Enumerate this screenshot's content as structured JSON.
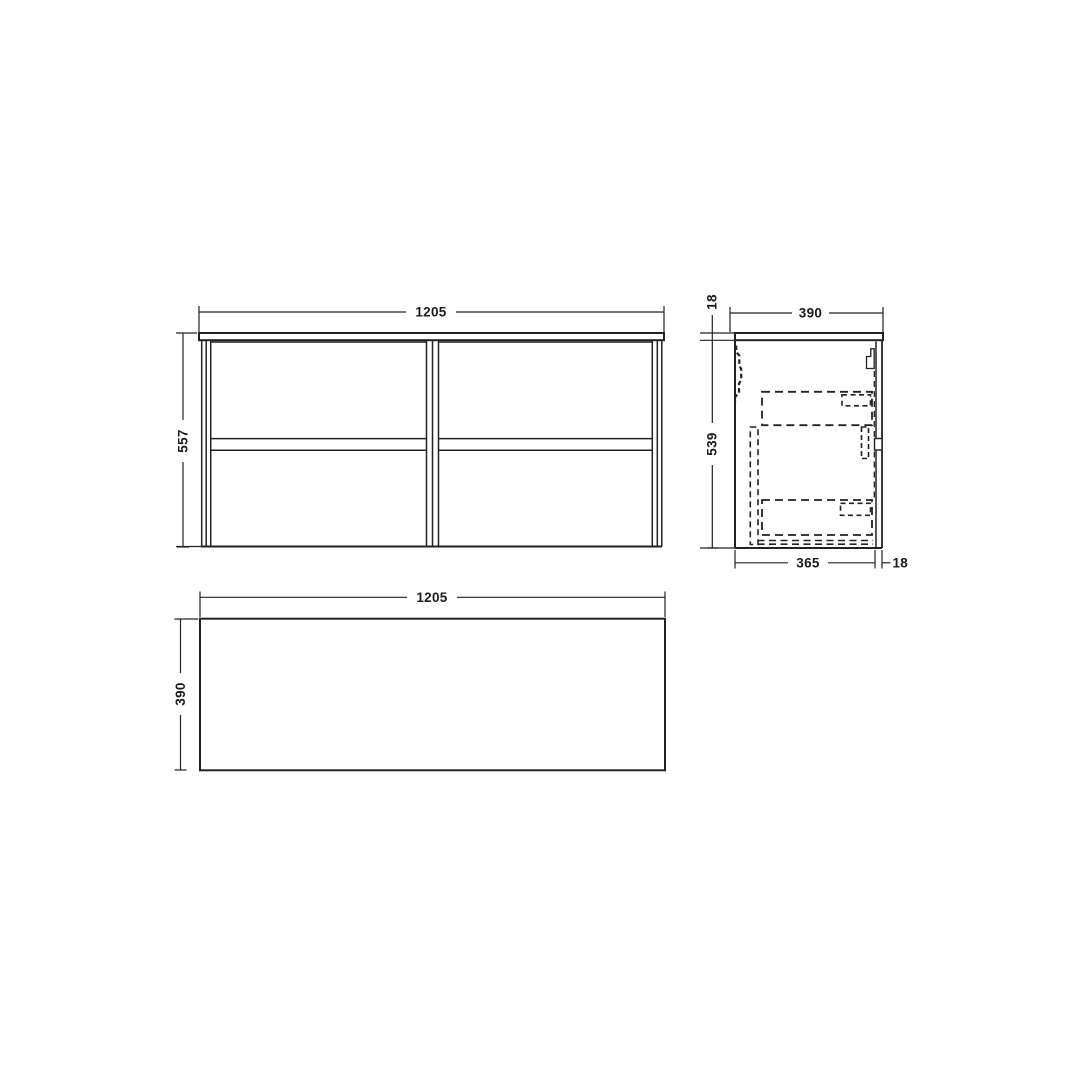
{
  "drawing": {
    "colors": {
      "line": "#222222",
      "background": "#ffffff"
    },
    "views": {
      "front": {
        "width": "1205",
        "height": "557"
      },
      "side": {
        "top_width": "390",
        "worktop_thickness": "18",
        "carcass_height": "539",
        "carcass_depth": "365",
        "front_thickness": "18"
      },
      "plan": {
        "width": "1205",
        "depth": "390"
      }
    }
  }
}
